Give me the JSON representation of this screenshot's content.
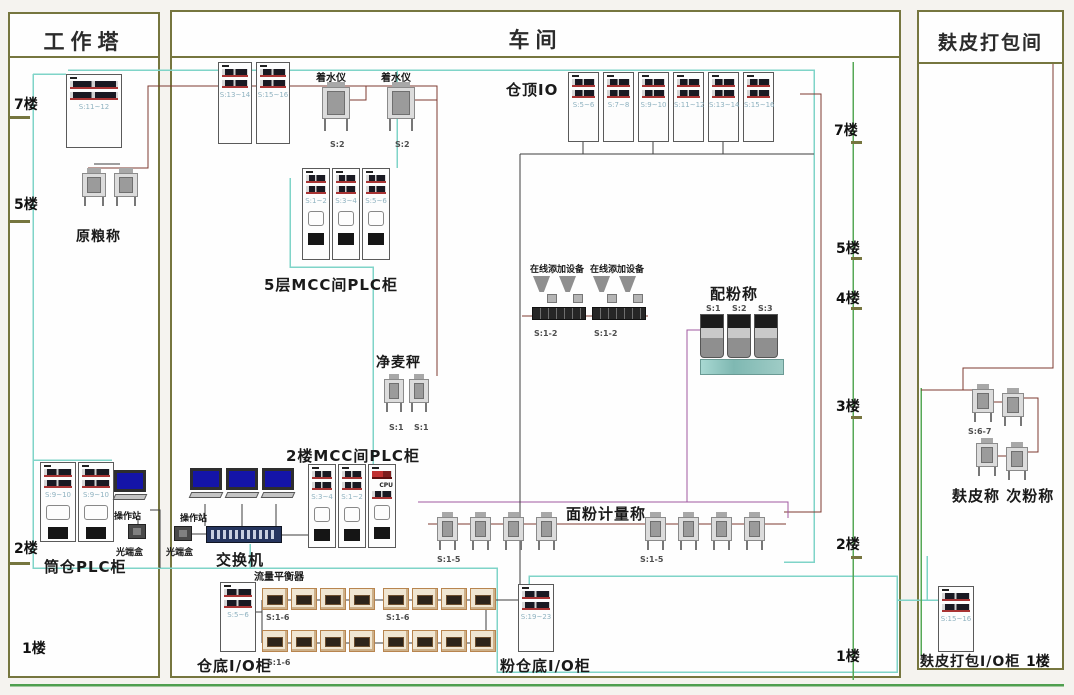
{
  "work_tower": {
    "title": "工作塔",
    "floors": [
      "7楼",
      "5楼",
      "2楼",
      "1楼"
    ],
    "plc_cabinet_label": "S:11~12",
    "raw_grain_scale_title": "原粮称",
    "silo_plc_title": "筒仓PLC柜",
    "silo_plc_cabinets": [
      "S:9~10",
      "S:9~10"
    ],
    "operator_station": "操作站",
    "optical_box": "光端盒"
  },
  "workshop": {
    "title": "车间",
    "floors": [
      "7楼",
      "5楼",
      "4楼",
      "3楼",
      "2楼",
      "1楼"
    ],
    "top_cabinets": [
      "S:13~14",
      "S:15~16"
    ],
    "water_device_title": "着水仪",
    "water_device_labels": [
      "S:2",
      "S:2"
    ],
    "silo_top_io_title": "仓顶IO",
    "silo_top_io_cabinets": [
      "S:5~6",
      "S:7~8",
      "S:9~10",
      "S:11~12",
      "S:13~14",
      "S:15~16"
    ],
    "mcc5_title": "5层MCC间PLC柜",
    "mcc5_cabinets": [
      "S:1~2",
      "S:3~4",
      "S:5~6"
    ],
    "additive_title": "在线添加设备",
    "additive_labels": [
      "S:1-2",
      "S:1-2"
    ],
    "clean_wheat_title": "净麦秤",
    "clean_wheat_labels": [
      "S:1",
      "S:1"
    ],
    "blend_title": "配粉称",
    "blend_labels": [
      "S:1",
      "S:2",
      "S:3"
    ],
    "mcc2_title": "2楼MCC间PLC柜",
    "mcc2_cabinets": [
      "S:3~4",
      "S:1~2"
    ],
    "mcc2_cpu": "CPU",
    "operator_station": "操作站",
    "switch": "交换机",
    "optical_box": "光端盒",
    "flour_meter_title": "面粉计量称",
    "flour_meter_labels": [
      "S:1-5",
      "S:1-5"
    ],
    "flow_balancer_title": "流量平衡器",
    "flow_balancer_labels": [
      "S:1-6",
      "S:1-6",
      "S:1-6"
    ],
    "silo_bottom_io_title": "仓底I/O柜",
    "silo_bottom_io_label": "S:5~6",
    "flour_silo_io_title": "粉仓底I/O柜",
    "flour_silo_io_label": "S:19~23"
  },
  "bran_room": {
    "title": "麸皮打包间",
    "scales_title": "麸皮称 次粉称",
    "scales_label": "S:6-7",
    "io_title": "麸皮打包I/O柜",
    "io_label": "S:15~16",
    "floor": "1楼"
  },
  "wire_colors": {
    "network_teal": "#7fd4c8",
    "ground_green": "#56a856",
    "power_maroon": "#7d3a30",
    "link_purple": "#a058a0",
    "signal_dark": "#3f3f3f",
    "panel_border_olive": "#76763f"
  }
}
